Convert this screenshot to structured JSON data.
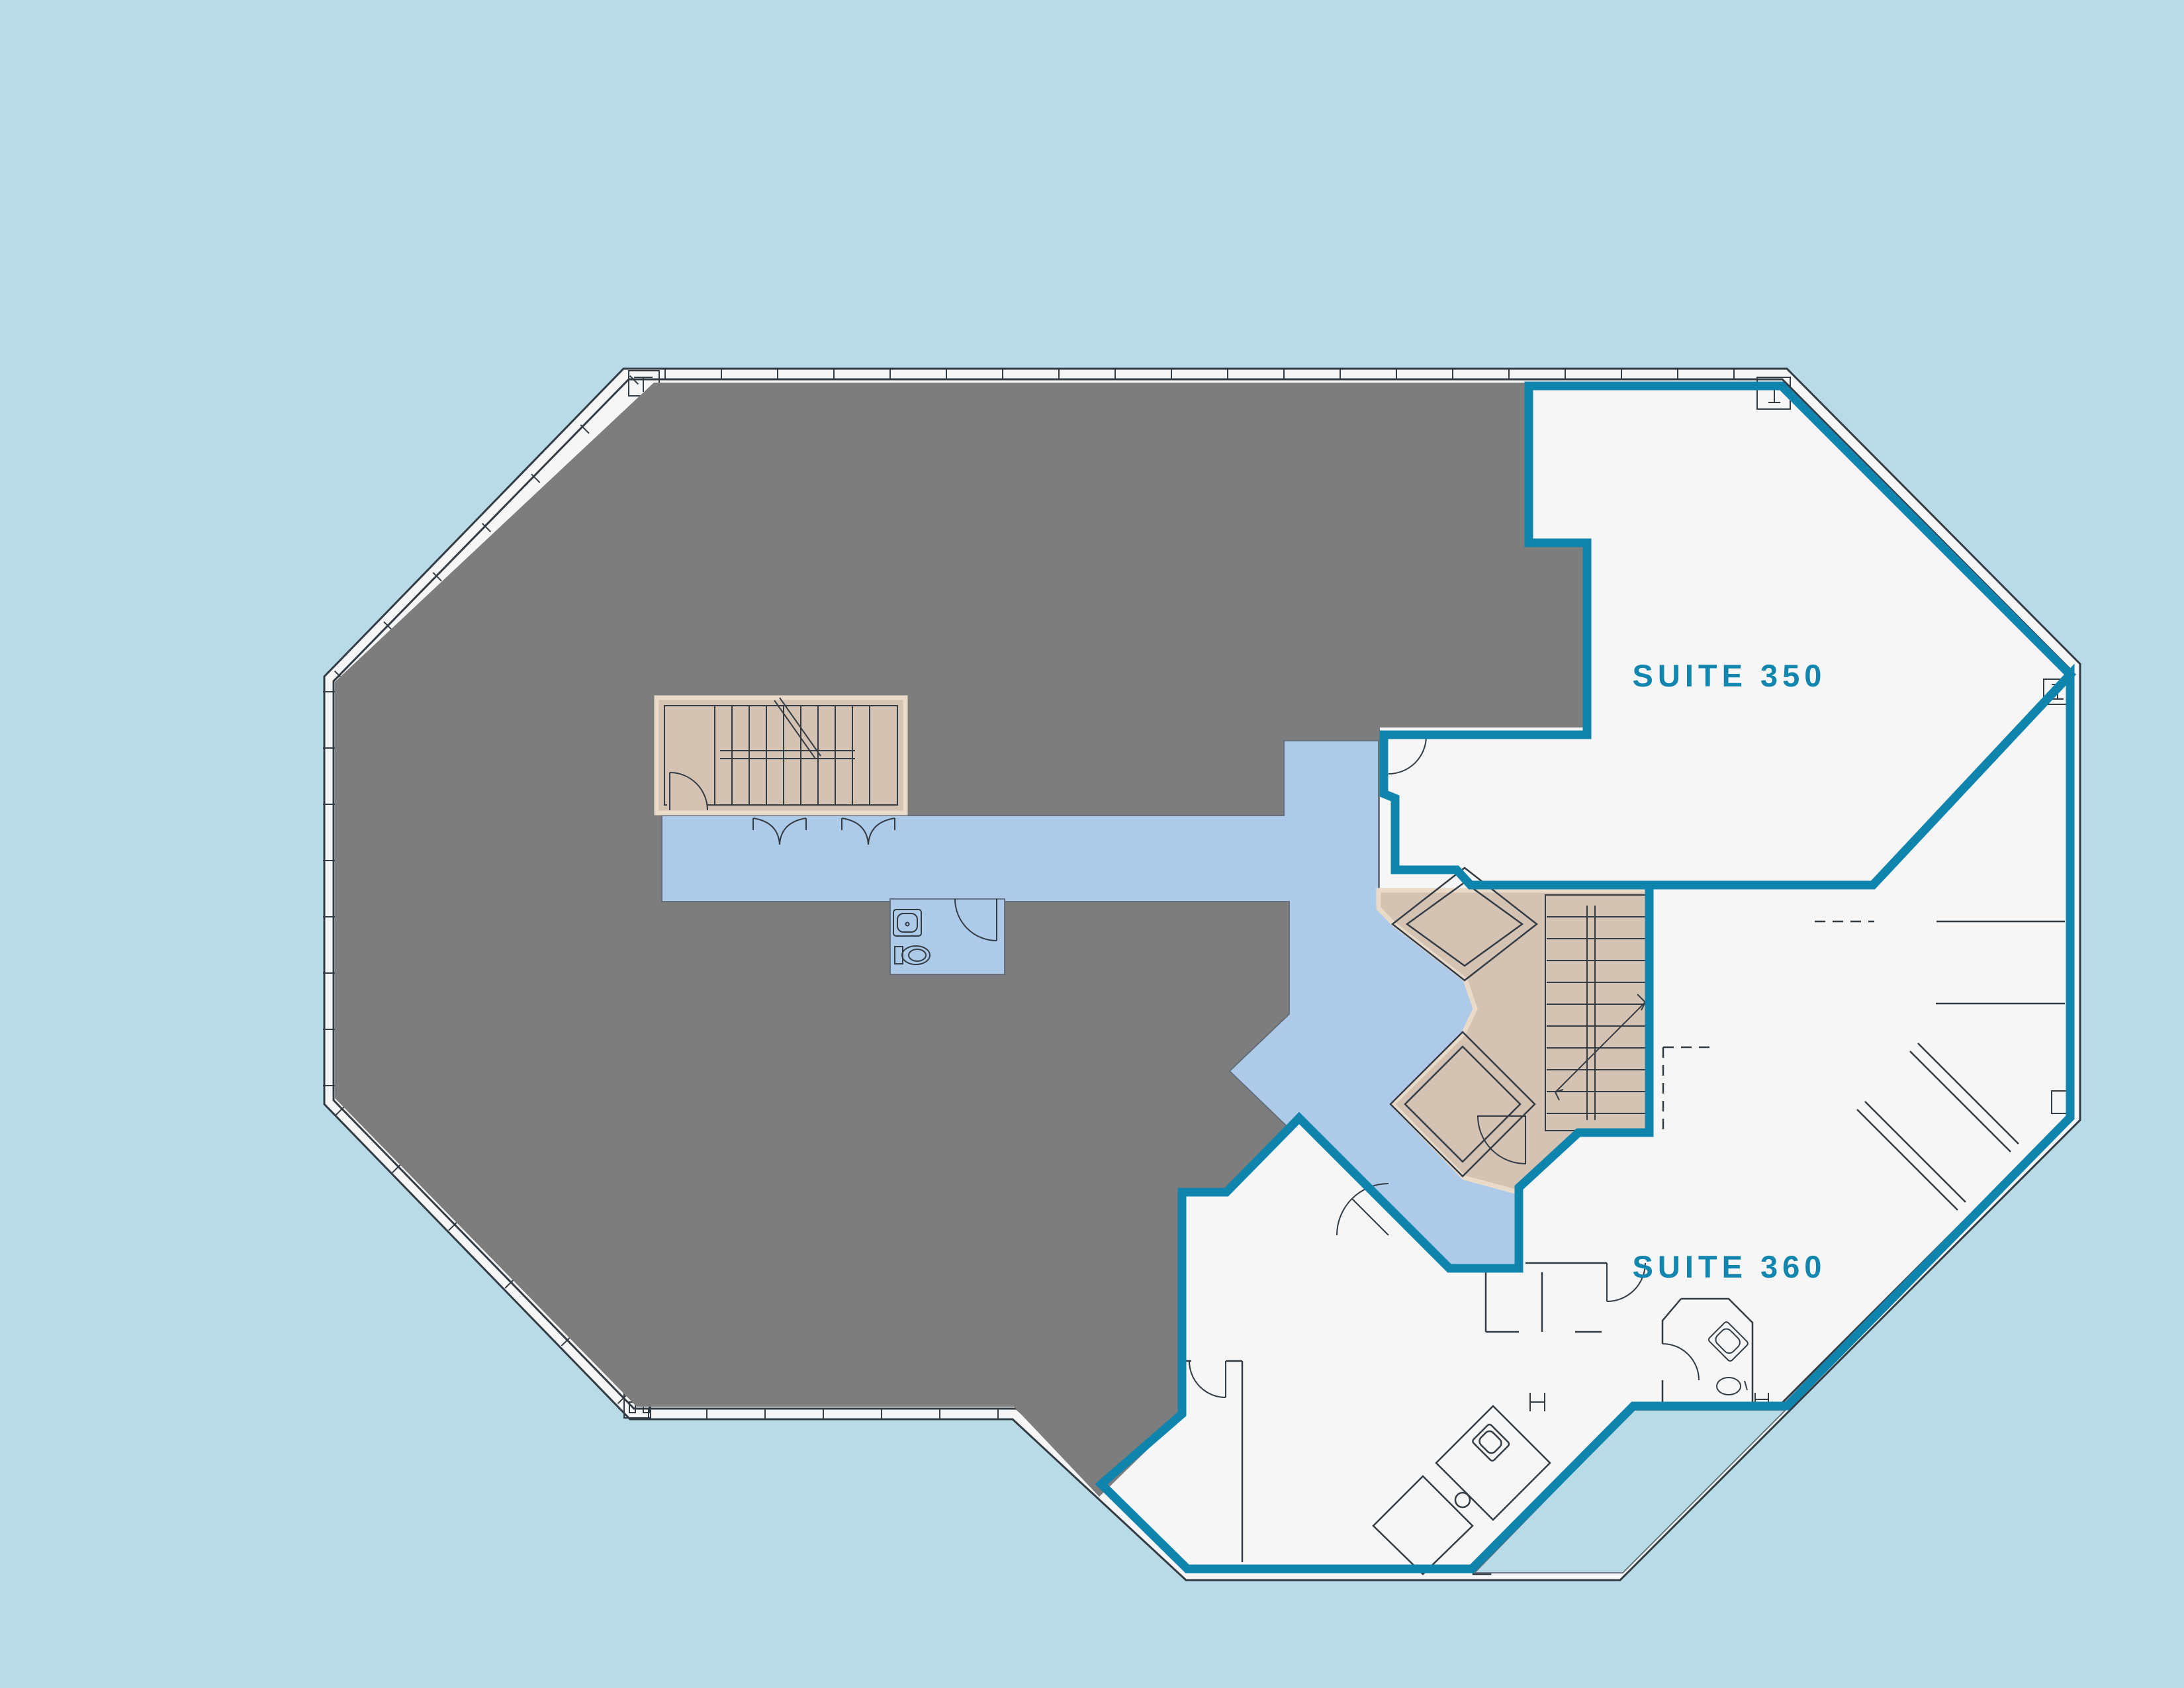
{
  "plan": {
    "suites": [
      {
        "id": "suite-350",
        "label": "SUITE 350",
        "status": "available"
      },
      {
        "id": "suite-360",
        "label": "SUITE 360",
        "status": "available"
      }
    ]
  },
  "colors": {
    "background": "#b8dbe7",
    "available_suite_fill": "#f5f6f5",
    "leased_area_fill": "#7d7d7d",
    "common_corridor_fill": "#adcbe9",
    "core_fill": "#d4c2b2",
    "core_edge": "#eadbc8",
    "suite_boundary_teal": "#0f84ac",
    "wall_line": "#333c44",
    "label_text": "#1286ae"
  }
}
